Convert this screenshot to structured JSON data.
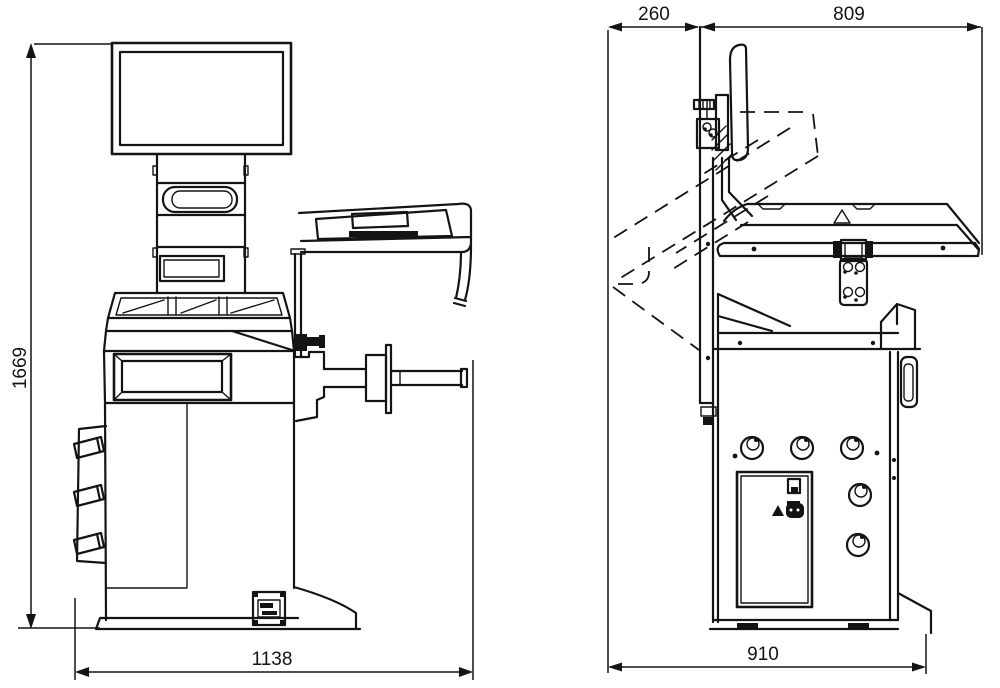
{
  "drawing": {
    "colors": {
      "line": "#141414",
      "background": "#ffffff"
    },
    "front_view": {
      "height_dim": "1669",
      "width_dim": "1138"
    },
    "side_view": {
      "front_offset_dim": "260",
      "guard_depth_dim": "809",
      "base_depth_dim": "910"
    }
  }
}
